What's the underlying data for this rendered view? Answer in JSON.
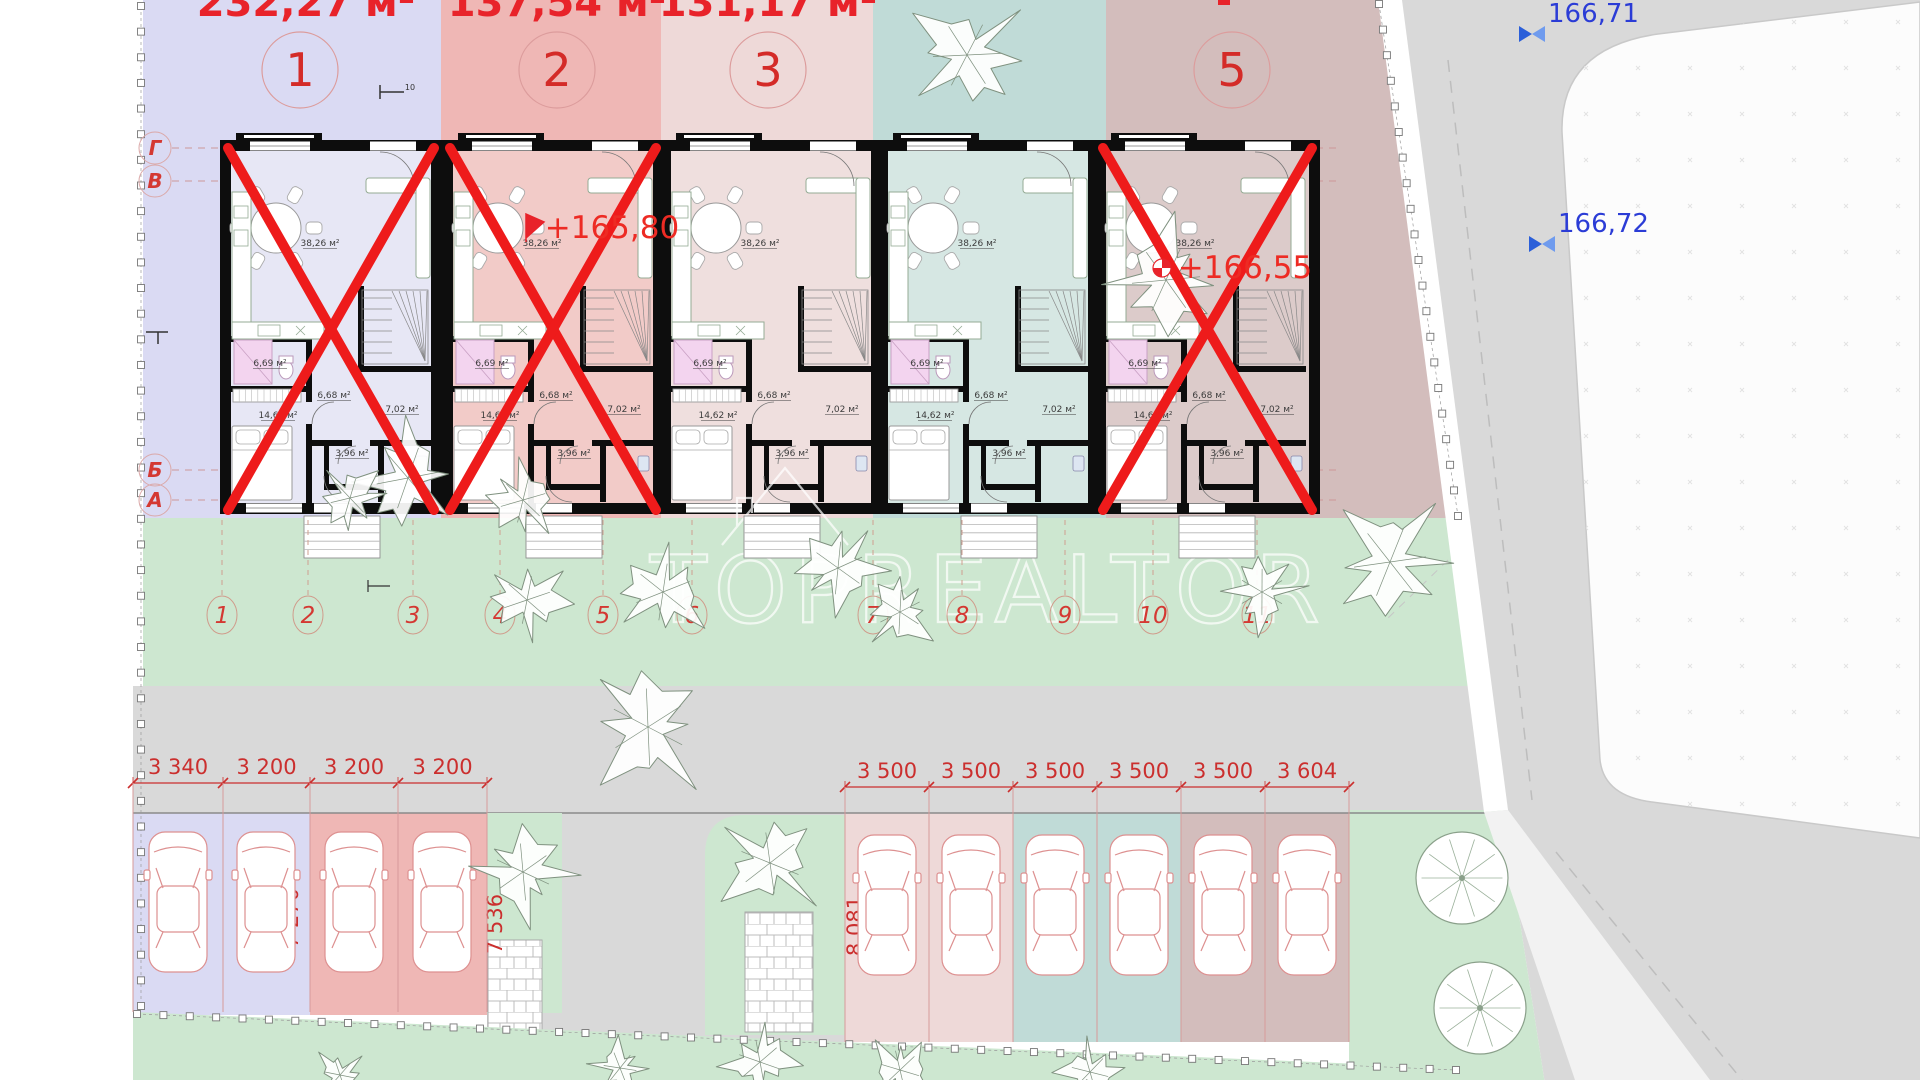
{
  "document": {
    "type": "residential-site-plan",
    "watermark": "TOPREALTOR"
  },
  "colors": {
    "red": "#e8232a",
    "cross_red": "#ee1b1b",
    "dim_red": "#cb2f2e",
    "blue": "#2b3cd6",
    "wall": "#0d0d0d",
    "green": "#cde7d0",
    "road": "#d9d9d9",
    "sidewalk": "#ffffff",
    "zone1": "#dadaf3",
    "zone2": "#efb7b5",
    "zone3": "#eed9d8",
    "zone4": "#c0dbd7",
    "zone5": "#d3bdbc",
    "floor1": "#e7e7f5",
    "floor2": "#f2cbc8",
    "floor3": "#efdfde",
    "floor4": "#d6e7e3",
    "floor5": "#dccbca"
  },
  "top_area_labels": [
    {
      "text": "232,27 м²",
      "x": 306
    },
    {
      "text": "137,54 м²",
      "x": 557
    },
    {
      "text": "131,17 м²",
      "x": 768
    }
  ],
  "unit_numbers": [
    {
      "label": "1",
      "x": 300,
      "y": 70
    },
    {
      "label": "2",
      "x": 557,
      "y": 70
    },
    {
      "label": "3",
      "x": 768,
      "y": 70
    },
    {
      "label": "5",
      "x": 1232,
      "y": 70
    }
  ],
  "grid_markers": [
    {
      "label": "Г",
      "y": 148
    },
    {
      "label": "В",
      "y": 181
    },
    {
      "label": "Б",
      "y": 470
    },
    {
      "label": "А",
      "y": 500
    }
  ],
  "elevation_marks": [
    {
      "text": "+165,80",
      "x": 612,
      "y": 238
    },
    {
      "text": "+166,55",
      "x": 1245,
      "y": 278
    }
  ],
  "benchmarks": [
    {
      "text": "166,71",
      "x": 1548,
      "y": 22
    },
    {
      "text": "166,72",
      "x": 1558,
      "y": 232
    }
  ],
  "room_areas": {
    "living": "38,26 м²",
    "bath": "6,69 м²",
    "hall": "6,68 м²",
    "room": "7,02 м²",
    "bedroom": "14,62 м²",
    "storage": "3,96 м²"
  },
  "units": [
    {
      "x": 220,
      "w": 222,
      "zone": 1,
      "crossed": true
    },
    {
      "x": 442,
      "w": 222,
      "zone": 2,
      "crossed": true
    },
    {
      "x": 660,
      "w": 222,
      "zone": 3,
      "crossed": false
    },
    {
      "x": 877,
      "w": 222,
      "zone": 4,
      "crossed": false
    },
    {
      "x": 1095,
      "w": 225,
      "zone": 5,
      "crossed": true
    }
  ],
  "lot_numbers": [
    {
      "label": "1",
      "x": 222
    },
    {
      "label": "2",
      "x": 308
    },
    {
      "label": "3",
      "x": 413
    },
    {
      "label": "4",
      "x": 500
    },
    {
      "label": "5",
      "x": 603
    },
    {
      "label": "6",
      "x": 692
    },
    {
      "label": "7",
      "x": 873
    },
    {
      "label": "8",
      "x": 962
    },
    {
      "label": "9",
      "x": 1065
    },
    {
      "label": "10",
      "x": 1153
    },
    {
      "label": "11",
      "x": 1257
    }
  ],
  "dimensions": {
    "left_row": {
      "y": 783,
      "ticks": [
        133,
        223,
        310,
        398,
        487
      ],
      "labels": [
        "3 340",
        "3 200",
        "3 200",
        "3 200"
      ]
    },
    "right_row": {
      "y": 787,
      "ticks": [
        845,
        929,
        1013,
        1097,
        1181,
        1265,
        1349
      ],
      "labels": [
        "3 500",
        "3 500",
        "3 500",
        "3 500",
        "3 500",
        "3 604"
      ]
    },
    "vertical": [
      {
        "text": "7 270",
        "x": 298,
        "y": 918
      },
      {
        "text": "7 536",
        "x": 502,
        "y": 924
      },
      {
        "text": "8 081",
        "x": 862,
        "y": 926
      },
      {
        "text": "8 957",
        "x": 1218,
        "y": 930
      }
    ]
  },
  "parking": {
    "left_stalls": [
      {
        "zone": 1,
        "x1": 133,
        "x2": 223
      },
      {
        "zone": 1,
        "x1": 223,
        "x2": 310
      },
      {
        "zone": 2,
        "x1": 310,
        "x2": 398
      },
      {
        "zone": 2,
        "x1": 398,
        "x2": 487
      }
    ],
    "right_stalls": [
      {
        "zone": 3,
        "x1": 845,
        "x2": 929
      },
      {
        "zone": 3,
        "x1": 929,
        "x2": 1013
      },
      {
        "zone": 4,
        "x1": 1013,
        "x2": 1097
      },
      {
        "zone": 4,
        "x1": 1097,
        "x2": 1181
      },
      {
        "zone": 5,
        "x1": 1181,
        "x2": 1265
      },
      {
        "zone": 5,
        "x1": 1265,
        "x2": 1349
      }
    ]
  }
}
